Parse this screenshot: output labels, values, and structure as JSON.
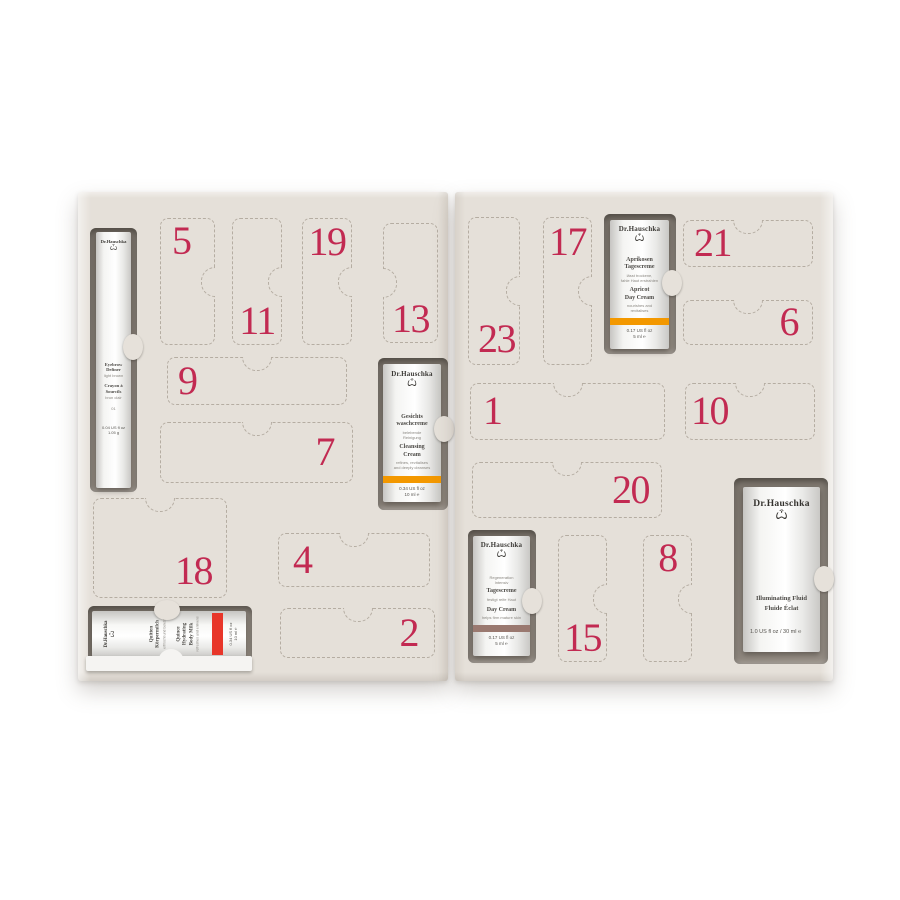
{
  "colors": {
    "page_bg": "#ffffff",
    "panel": "#e5e0d9",
    "slot": "#8e8780",
    "number": "#c22a52",
    "orange_band": "#f39800",
    "red_band": "#e8362a",
    "mauve_band": "#9a7970"
  },
  "doors": {
    "d1": "1",
    "d2": "2",
    "d4": "4",
    "d5": "5",
    "d6": "6",
    "d7": "7",
    "d8": "8",
    "d9": "9",
    "d10": "10",
    "d11": "11",
    "d13": "13",
    "d15": "15",
    "d17": "17",
    "d18": "18",
    "d19": "19",
    "d20": "20",
    "d21": "21",
    "d23": "23"
  },
  "products": {
    "eyebrow_definer": {
      "brand": "Dr.Hauschka",
      "logo": "Ѽ",
      "name_en_l1": "Eyebrow",
      "name_en_l2": "Definer",
      "shade_en": "light brown",
      "name_fr_l1": "Crayon à",
      "name_fr_l2": "Sourcils",
      "shade_fr": "brun clair",
      "shade_no": "01",
      "size": "0.04 US fl oz",
      "weight": "1.05 g"
    },
    "cleansing_cream": {
      "brand": "Dr.Hauschka",
      "logo": "Ѽ",
      "name_de_l1": "Gesichts",
      "name_de_l2": "waschcreme",
      "sub_de_l1": "belebende",
      "sub_de_l2": "Reinigung",
      "name_en_l1": "Cleansing",
      "name_en_l2": "Cream",
      "sub_en_l1": "refines, revitalises",
      "sub_en_l2": "and deeply cleanses",
      "band_color": "#f39800",
      "size": "0.34 US fl oz",
      "volume": "10 ml ℮"
    },
    "quince_body_milk": {
      "brand": "Dr.Hauschka",
      "logo": "Ѽ",
      "name_de_l1": "Quitten",
      "name_de_l2": "Körpermilch",
      "sub_de": "erfrischt und belebt",
      "name_en_l1": "Quince",
      "name_en_l2": "Hydrating",
      "name_en_l3": "Body Milk",
      "sub_en": "refreshes and enlivens",
      "band_color": "#e8362a",
      "size": "0.34 US fl oz",
      "volume": "10 ml ℮"
    },
    "apricot_day_cream": {
      "brand": "Dr.Hauschka",
      "logo": "Ѽ",
      "name_de_l1": "Aprikosen",
      "name_de_l2": "Tagescreme",
      "sub_de_l1": "lässt trockene,",
      "sub_de_l2": "fahle Haut erstrahlen",
      "name_en_l1": "Apricot",
      "name_en_l2": "Day Cream",
      "sub_en_l1": "nourishes and",
      "sub_en_l2": "revitalises",
      "band_color": "#f39800",
      "size": "0.17 US fl oz",
      "volume": "5 ml ℮"
    },
    "day_cream": {
      "brand": "Dr.Hauschka",
      "logo": "Ѽ",
      "range_l1": "Regeneration",
      "range_l2": "Intensiv",
      "name_de": "Tagescreme",
      "sub_de": "festigt reife Haut",
      "name_en": "Day Cream",
      "sub_en": "helps firm mature skin",
      "band_color": "#9a7970",
      "size": "0.17 US fl oz",
      "volume": "5 ml ℮"
    },
    "illuminating_fluid": {
      "brand": "Dr.Hauschka",
      "logo": "Ѽ",
      "name_en": "Illuminating Fluid",
      "name_fr": "Fluide Éclat",
      "size": "1.0 US fl oz / 30 ml ℮"
    }
  }
}
